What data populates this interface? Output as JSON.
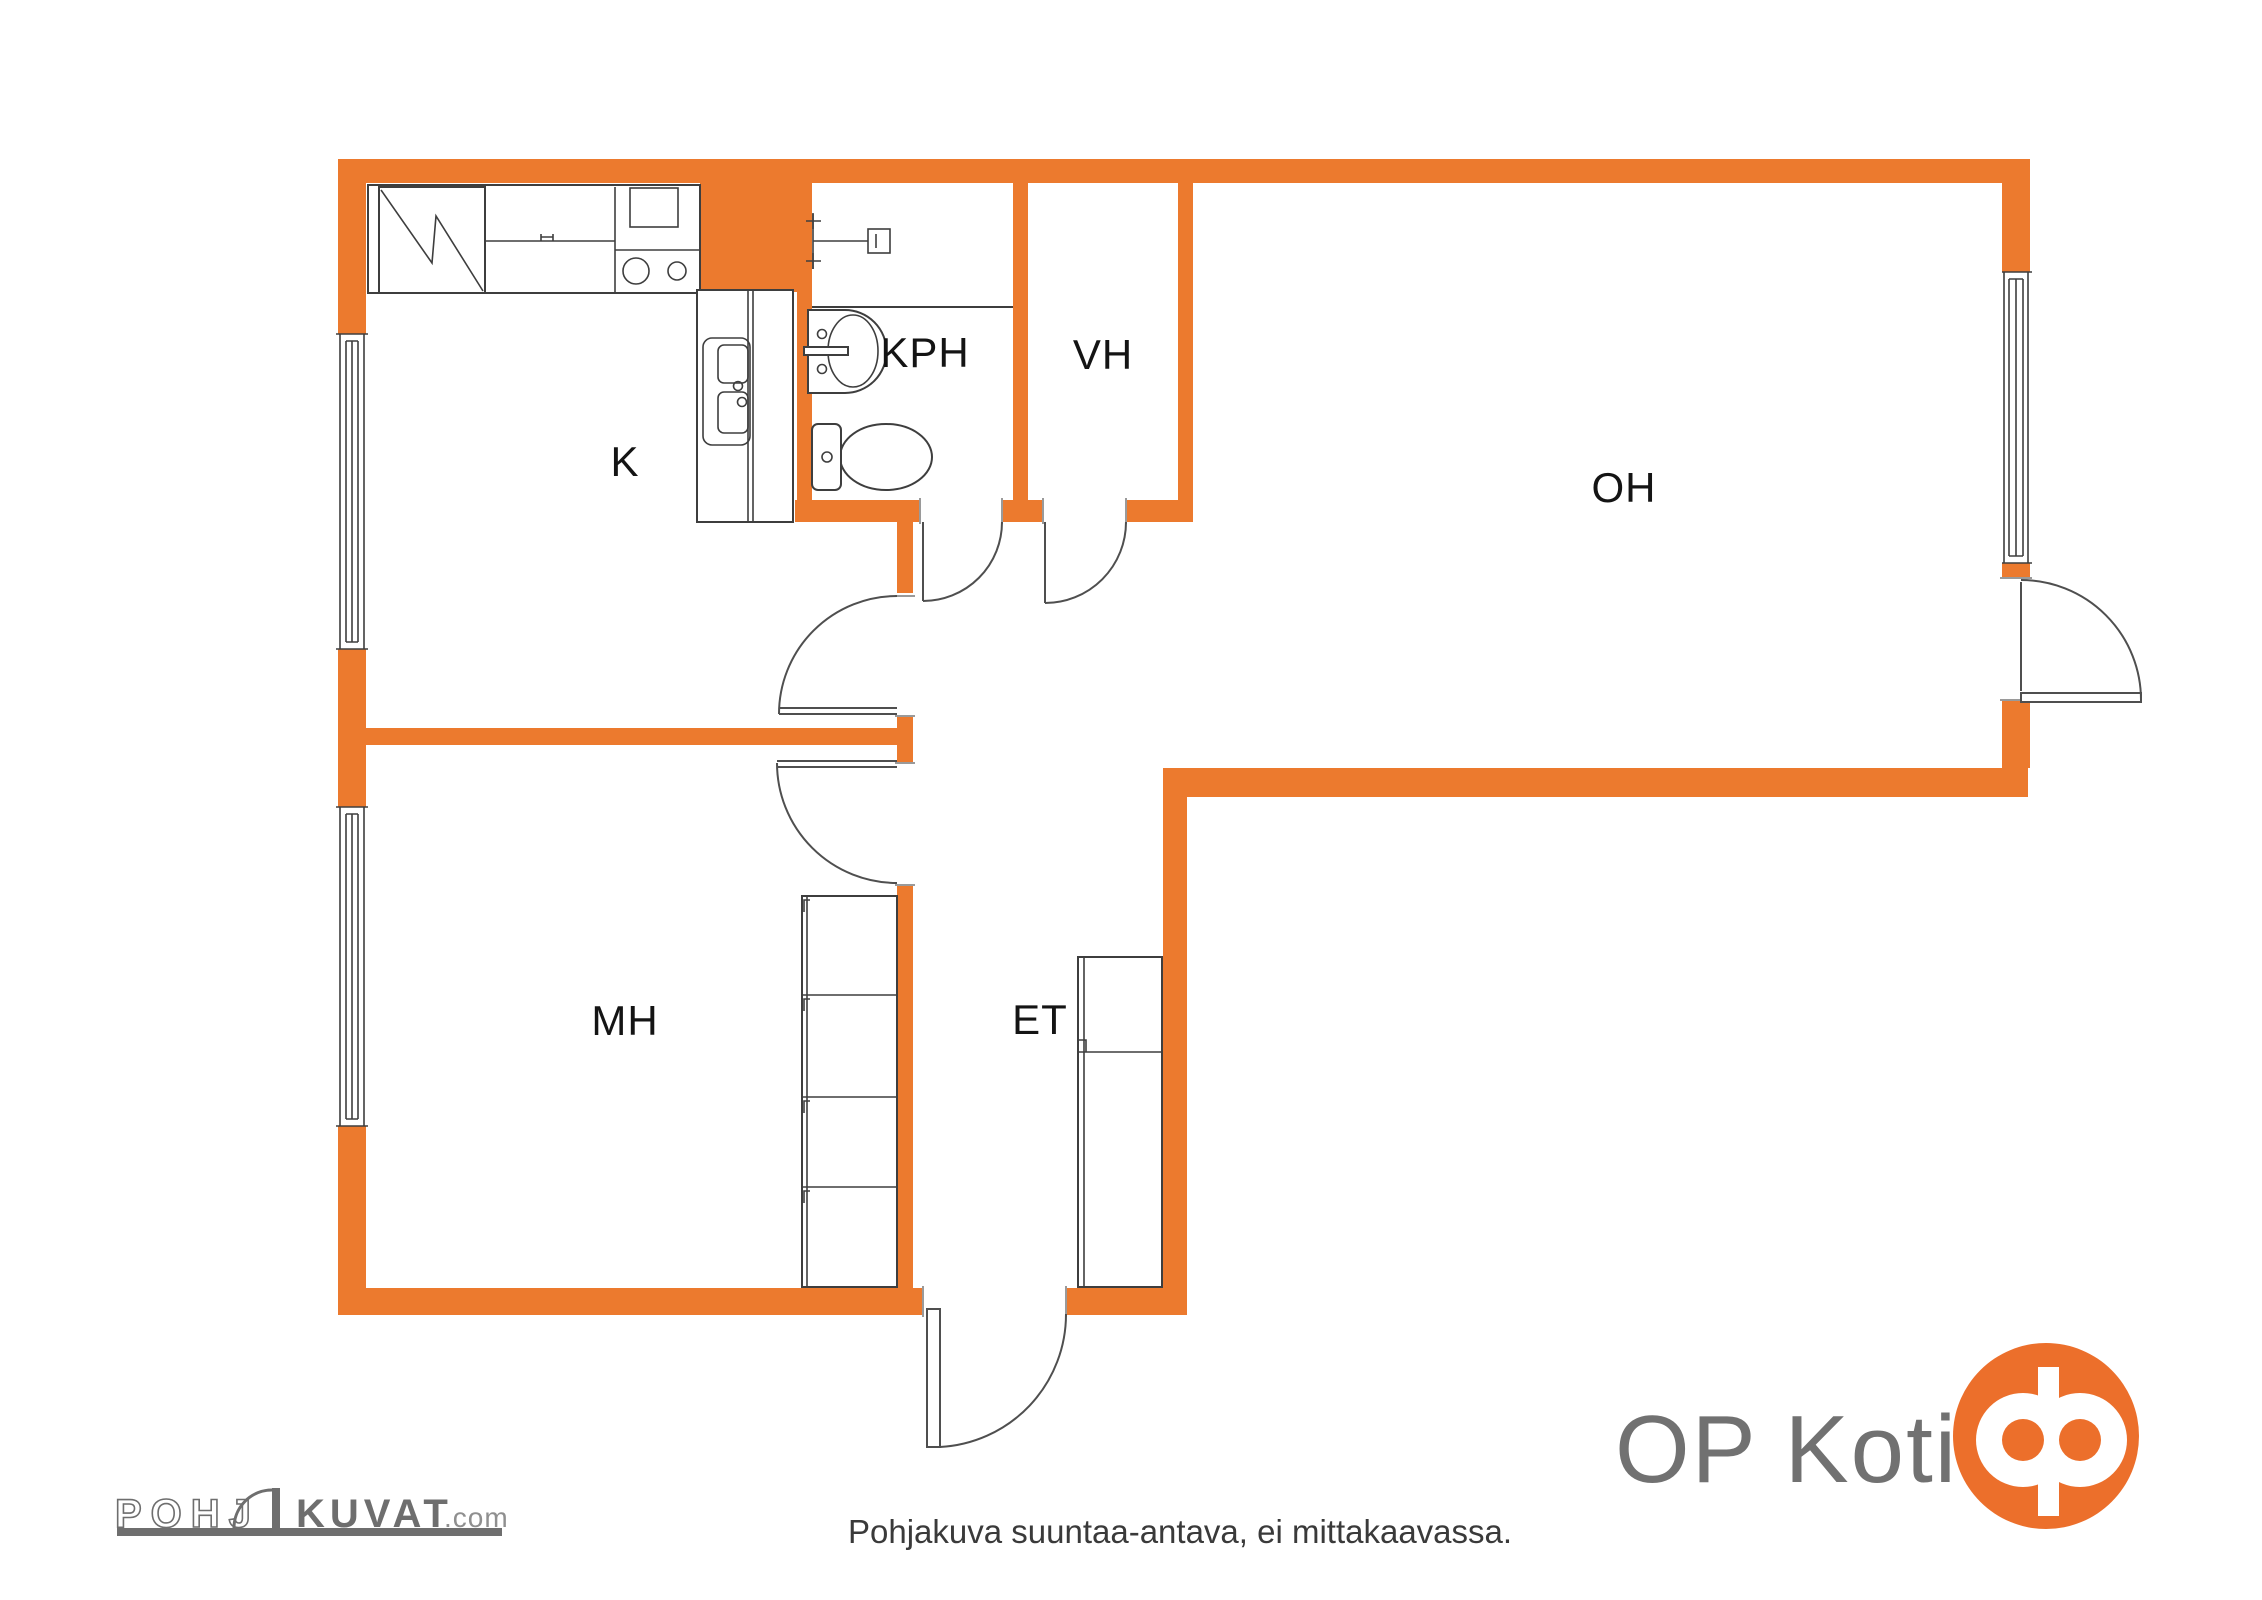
{
  "rooms": [
    {
      "id": "k",
      "label": "K"
    },
    {
      "id": "kph",
      "label": "KPH"
    },
    {
      "id": "vh",
      "label": "VH"
    },
    {
      "id": "oh",
      "label": "OH"
    },
    {
      "id": "mh",
      "label": "MH"
    },
    {
      "id": "et",
      "label": "ET"
    }
  ],
  "footer": {
    "note": "Pohjakuva suuntaa-antava, ei mittakaavassa."
  },
  "branding": {
    "pohjakuvat_prefix": "POHJ",
    "pohjakuvat_main": "KUVAT",
    "pohjakuvat_tld": ".com",
    "op_koti_text": "OP Koti"
  },
  "fixtures": [
    "fridge-icon",
    "stove-icon",
    "kitchen-sink-icon",
    "shower-icon",
    "washbasin-icon",
    "toilet-icon",
    "wardrobe-icon",
    "window-icon",
    "door-swing-icon"
  ],
  "colors": {
    "wall_orange": "#EC7A2E",
    "logo_orange": "#EC6F2B",
    "line_dark": "#3E3E3E",
    "label_text": "#141414",
    "footer_text": "#3A3A3A",
    "brand_gray": "#6E6E6E",
    "tld_gray": "#8F8F8F",
    "op_koti_text_gray": "#717171"
  }
}
